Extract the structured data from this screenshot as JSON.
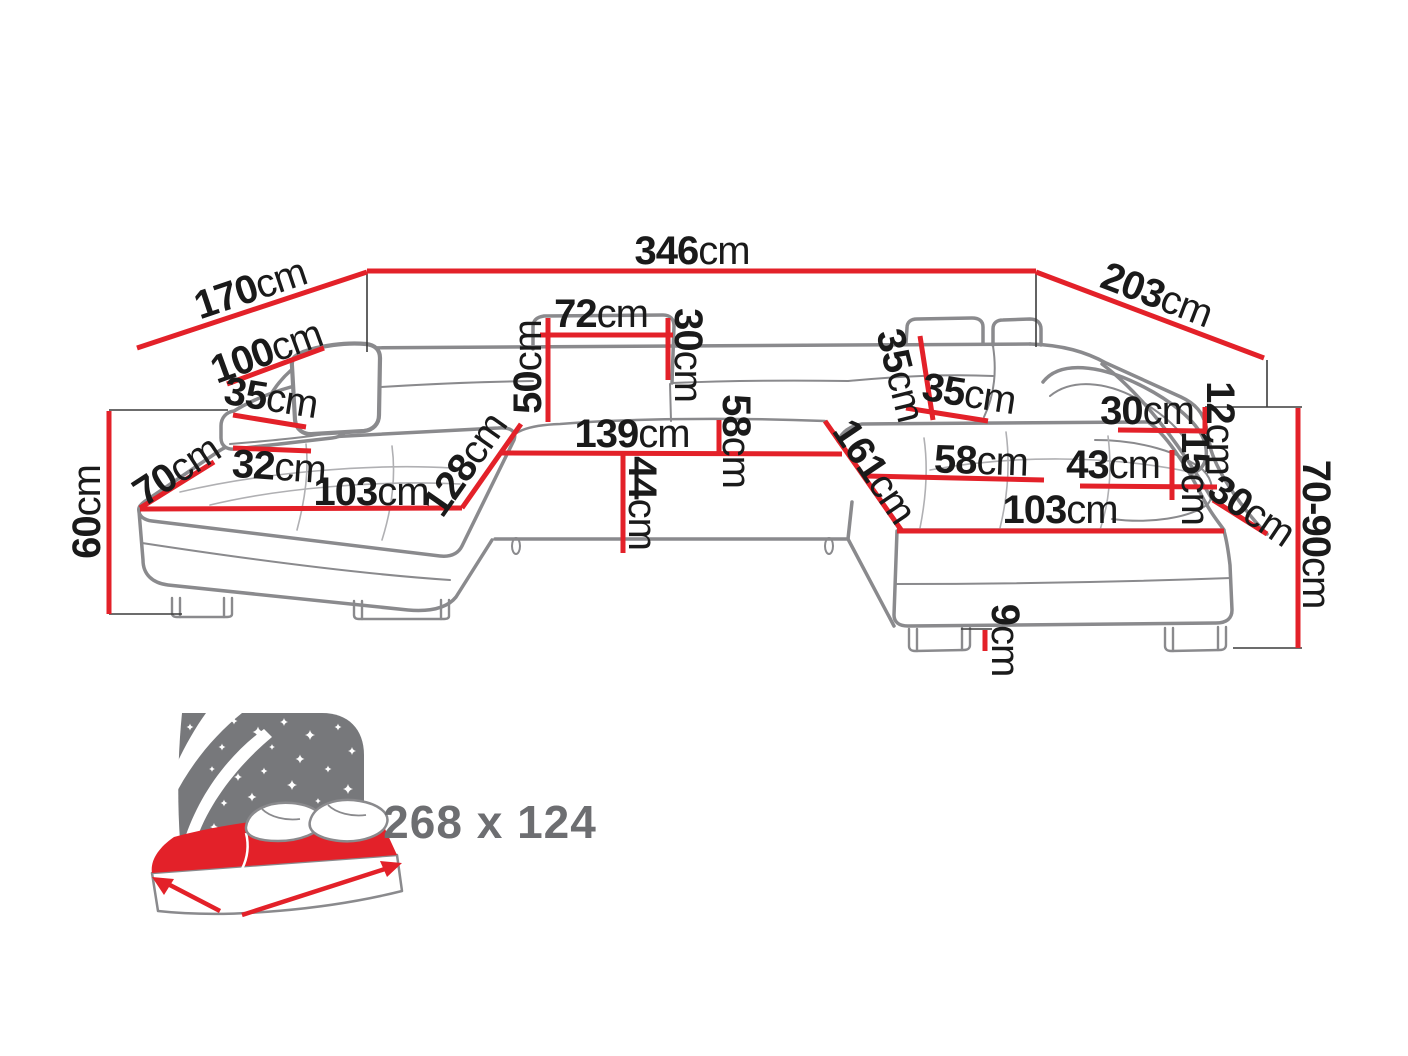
{
  "figure": {
    "type": "furniture-dimension-diagram",
    "subject": "U-shaped corner sofa bed, front perspective view with dimension lines",
    "unit": "cm",
    "colors": {
      "accent_red": "#e32129",
      "outline_gray": "#8a8a8d",
      "seam_gray": "#b0b0b3",
      "extension_black": "#3c3c3c",
      "icon_gray": "#77787b",
      "label_gray": "#6d6e71",
      "text_black": "#1a1a1a",
      "background": "#ffffff"
    }
  },
  "dims": [
    {
      "name": "back-edge-left",
      "value": "170",
      "unit": "cm"
    },
    {
      "name": "back-edge-total",
      "value": "346",
      "unit": "cm"
    },
    {
      "name": "back-edge-right",
      "value": "203",
      "unit": "cm"
    },
    {
      "name": "left-backrest-width",
      "value": "100",
      "unit": "cm"
    },
    {
      "name": "left-armrest-width",
      "value": "35",
      "unit": "cm"
    },
    {
      "name": "left-armrest-front-width",
      "value": "32",
      "unit": "cm"
    },
    {
      "name": "left-corner-depth",
      "value": "70",
      "unit": "cm"
    },
    {
      "name": "seat-height-left",
      "value": "60",
      "unit": "cm"
    },
    {
      "name": "left-chaise-length",
      "value": "103",
      "unit": "cm"
    },
    {
      "name": "left-section-depth",
      "value": "128",
      "unit": "cm"
    },
    {
      "name": "backrest-height",
      "value": "50",
      "unit": "cm"
    },
    {
      "name": "headrest-width",
      "value": "72",
      "unit": "cm"
    },
    {
      "name": "headrest-height",
      "value": "30",
      "unit": "cm"
    },
    {
      "name": "center-seat-width",
      "value": "139",
      "unit": "cm"
    },
    {
      "name": "seat-height-center",
      "value": "44",
      "unit": "cm"
    },
    {
      "name": "seat-depth-center",
      "value": "58",
      "unit": "cm"
    },
    {
      "name": "right-back-cushion-width",
      "value": "35",
      "unit": "cm"
    },
    {
      "name": "right-backrest-width",
      "value": "35",
      "unit": "cm"
    },
    {
      "name": "right-section-depth",
      "value": "161",
      "unit": "cm"
    },
    {
      "name": "right-seat-width",
      "value": "58",
      "unit": "cm"
    },
    {
      "name": "right-armrest-length",
      "value": "43",
      "unit": "cm"
    },
    {
      "name": "right-headrest-width",
      "value": "30",
      "unit": "cm"
    },
    {
      "name": "right-armrest-top-width",
      "value": "12",
      "unit": "cm"
    },
    {
      "name": "right-armrest-height",
      "value": "15",
      "unit": "cm"
    },
    {
      "name": "right-armrest-slope",
      "value": "30",
      "unit": "cm"
    },
    {
      "name": "right-chaise-length",
      "value": "103",
      "unit": "cm"
    },
    {
      "name": "overall-height-range",
      "value": "70-90",
      "unit": "cm"
    },
    {
      "name": "leg-height",
      "value": "9",
      "unit": "cm"
    }
  ],
  "sleeping_area": {
    "label": "268 x 124",
    "width_cm": 268,
    "depth_cm": 124
  }
}
